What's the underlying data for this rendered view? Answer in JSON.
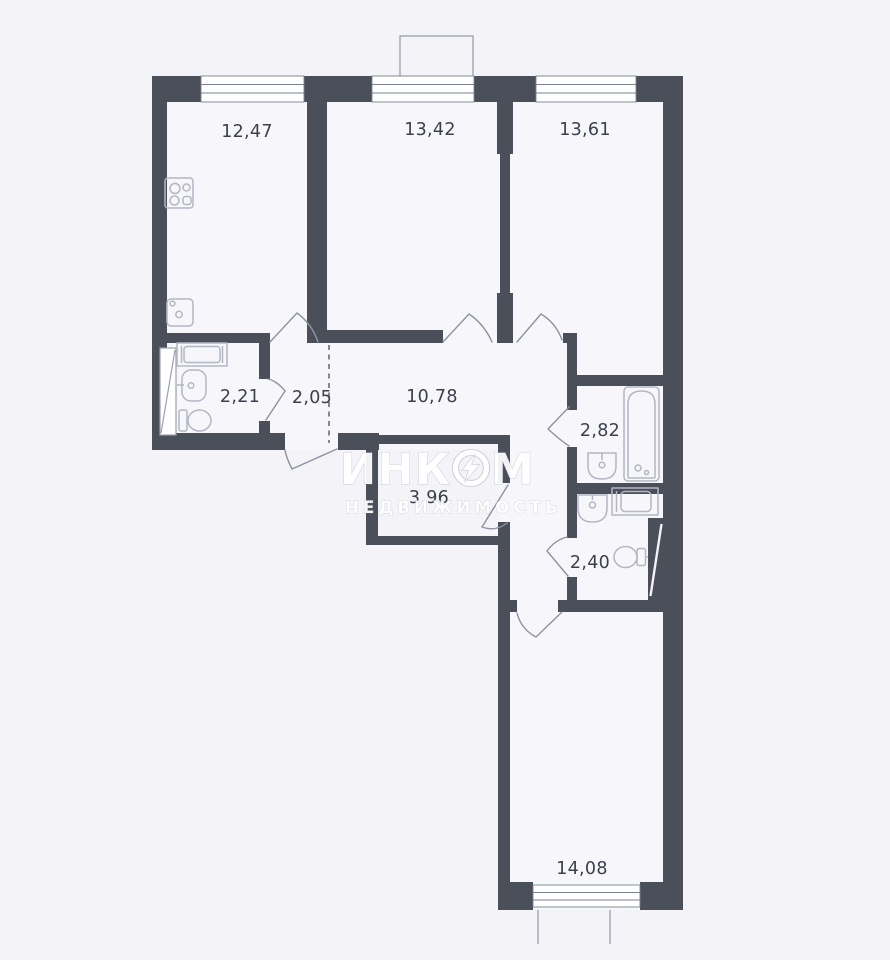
{
  "title": "apartment-floor-plan",
  "colors": {
    "background": "#f3f3f8",
    "wall": "#4b4f5a",
    "label_text": "#3b404c",
    "fixture_line": "#b3b7c3",
    "door_line": "#8d93a0",
    "watermark": "#ffffff"
  },
  "rooms": [
    {
      "id": "kitchen",
      "area": "12,47"
    },
    {
      "id": "room-13-42",
      "area": "13,42"
    },
    {
      "id": "room-13-61",
      "area": "13,61"
    },
    {
      "id": "bathroom-2-21",
      "area": "2,21"
    },
    {
      "id": "hallway-2-05",
      "area": "2,05"
    },
    {
      "id": "corridor",
      "area": "10,78"
    },
    {
      "id": "bathroom-2-82",
      "area": "2,82"
    },
    {
      "id": "storage-3-96",
      "area": "3,96"
    },
    {
      "id": "wc-2-40",
      "area": "2,40"
    },
    {
      "id": "room-14-08",
      "area": "14,08"
    }
  ],
  "watermark": {
    "brand_part1": "ИНК",
    "brand_part2": "М",
    "subtitle": "НЕДВИЖИМОСТЬ"
  }
}
